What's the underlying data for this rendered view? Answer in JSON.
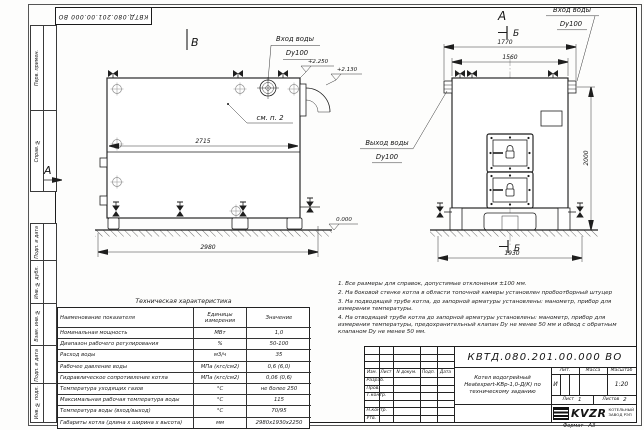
{
  "stamp": {
    "designation": "КВТД.080.201.00.000 ВО"
  },
  "margin_fields": [
    "Перв. примен.",
    "Справ. №",
    "Подп. и дата",
    "Инв. № дубл.",
    "Взам. инв. №",
    "Подп. и дата",
    "Инв. № подл."
  ],
  "drawing": {
    "labels": {
      "view_b": "В",
      "view_a": "А",
      "section_b": "Б",
      "inlet": "Вход воды",
      "outlet": "Выход воды",
      "dn": "Dy100",
      "see_note": "см. п. 2"
    },
    "dims": {
      "side_inner_width": "2715",
      "side_total_width": "2980",
      "front_flange_span": "1770",
      "front_top_width": "1560",
      "front_height": "2000",
      "front_bottom_width": "1930"
    },
    "elev": {
      "top": "+2.250",
      "pipe": "+2.130",
      "zero": "0.000"
    }
  },
  "notes": [
    "1. Все размеры для справок, допустимые отклонения ±100 мм.",
    "2. На боковой стенке котла в области топочной камеры установлен пробоотборный штуцер",
    "3. На подводящей трубе котла, до запорной арматуры установлены: манометр, прибор для измерения температуры.",
    "4. На отводящей трубе котла до запорной арматуры установлены: манометр, прибор для измерения температуры, предохранительный клапан Dу не менее 50 мм и обвод с обратным клапаном Dу не менее 50 мм."
  ],
  "spec_table": {
    "title": "Техническая характеристика",
    "headers": [
      "Наименование показателя",
      "Единицы измерения",
      "Значение"
    ],
    "rows": [
      {
        "name": "Номинальная мощность",
        "unit": "МВт",
        "value": "1,0"
      },
      {
        "name": "Диапазон рабочего регулирования",
        "unit": "%",
        "value": "50-100"
      },
      {
        "name": "Расход воды",
        "unit": "м3/ч",
        "value": "35"
      },
      {
        "name": "Рабочее давление воды",
        "unit": "МПа (кгс/см2)",
        "value": "0,6 (6,0)"
      },
      {
        "name": "Гидравлическое сопротивление котла",
        "unit": "МПа (кгс/см2)",
        "value": "0,06 (0,6)"
      },
      {
        "name": "Температура уходящих газов",
        "unit": "°С",
        "value": "не более 250"
      },
      {
        "name": "Максимальная рабочая температура воды",
        "unit": "°С",
        "value": "115"
      },
      {
        "name": "Температура воды (вход/выход)",
        "unit": "°С",
        "value": "70/95"
      },
      {
        "name": "Габариты котла (длина х ширина х высота)",
        "unit": "мм",
        "value": "2980х1930х2250"
      }
    ]
  },
  "title_block": {
    "designation": "КВТД.080.201.00.000 ВО",
    "name_line1": "Котел водогрейный",
    "name_line2": "Heatexpert-КВр-1,0-Д(К) по",
    "name_line3": "техническому заданию",
    "col_izm": "Изм.",
    "col_list": "Лист",
    "col_doc": "N докум.",
    "col_sign": "Подп.",
    "col_date": "Дата",
    "row_razrab": "Разраб.",
    "row_prov": "Пров.",
    "row_tkontr": "Т.контр.",
    "row_nkontr": "Н.контр.",
    "row_utv": "Утв.",
    "lit_header": "Лит.",
    "mass_header": "Масса",
    "scale_header": "Масштаб",
    "lit_value": "И",
    "scale_value": "1:20",
    "sheet_label": "Лист",
    "sheet_value": "1",
    "sheets_label": "Листов",
    "sheets_value": "2",
    "logo_text": "KVZR",
    "company_line1": "КОТЕЛЬНЫЙ",
    "company_line2": "ЗАВОД РЭП",
    "format_label": "Формат",
    "format_value": "А3"
  }
}
